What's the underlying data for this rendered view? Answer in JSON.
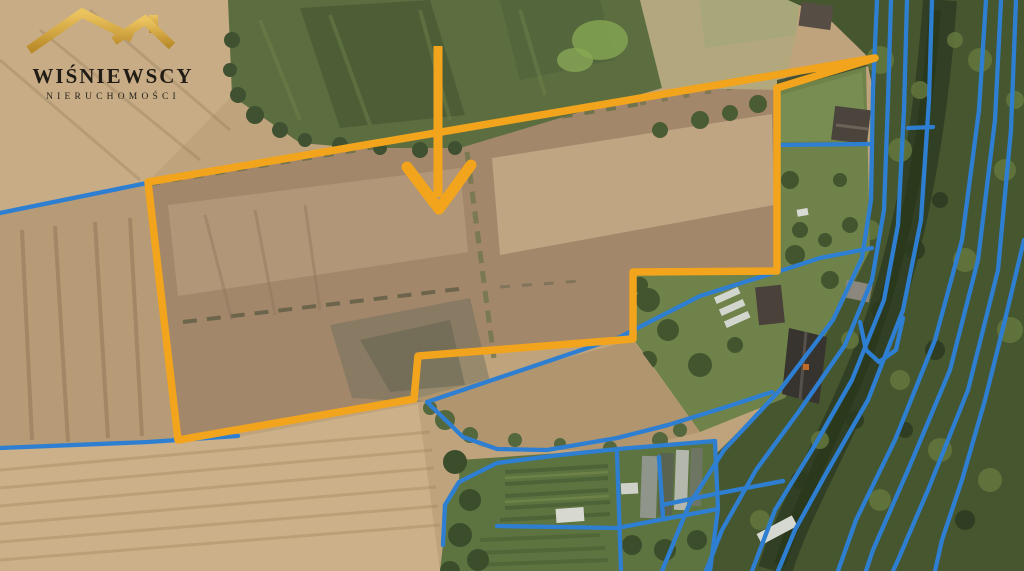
{
  "brand": {
    "name": "WIŚNIEWSCY",
    "subtitle": "NIERUCHOMOŚCI",
    "gold_color": "#D9A944",
    "text_color": "#211c16"
  },
  "map": {
    "canvas": {
      "width": 1024,
      "height": 571
    },
    "colors": {
      "plot_outline": "#F2A41C",
      "arrow": "#F2A41C",
      "cadastral": "#2E7FD2"
    },
    "plot_outline": {
      "stroke_width": 7.5,
      "points": "148,182 875,58 777,88 777,271 633,272 633,339 418,356 414,399 178,440"
    },
    "arrow": {
      "shaft_points": "438,46 438,197",
      "head_points": "407,167 439,209 471,165",
      "shaft_width": 9,
      "head_width": 11
    },
    "cadastral_lines": {
      "stroke_width": 4.3,
      "lines": [
        {
          "name": "boundary-nw",
          "points": "0,213 147,183"
        },
        {
          "name": "boundary-sw",
          "points": "0,448 148,442 238,436"
        },
        {
          "name": "homestead-boundary",
          "points": "872,248 820,258 783,270 700,296 620,337 427,402 463,437 497,449 547,450 617,438 668,425 726,407 772,392"
        },
        {
          "name": "garden-top",
          "points": "443,545 445,505 459,482 497,463 560,455 618,449 715,441"
        },
        {
          "name": "garden-bottom",
          "points": "497,526 560,527 617,528 718,509"
        },
        {
          "name": "garden-divider-1",
          "points": "617,452 621,571"
        },
        {
          "name": "garden-divider-2",
          "points": "659,457 663,517"
        },
        {
          "name": "garden-right-edge",
          "points": "715,441 718,509 710,571"
        },
        {
          "name": "connector-1",
          "points": "777,145 872,144"
        },
        {
          "name": "connector-2",
          "points": "908,128 933,127"
        },
        {
          "name": "connector-3",
          "points": "662,505 720,493 783,481"
        },
        {
          "name": "u-connector",
          "points": "903,318 896,350 879,362 866,350 860,322"
        },
        {
          "name": "river-line-1",
          "points": "877,0 873,90 871,200 862,258 833,320 780,390 724,450 689,505 662,571"
        },
        {
          "name": "river-line-2",
          "points": "891,0 888,100 884,210 872,280 845,345 800,410 756,470 722,530 706,571"
        },
        {
          "name": "river-line-3",
          "points": "907,0 904,110 898,225 884,300 852,380 812,450 775,510 752,571"
        },
        {
          "name": "river-line-4",
          "points": "932,0 929,100 921,220 903,310 868,400 828,470 795,530 778,571"
        },
        {
          "name": "river-line-5",
          "points": "986,0 979,110 962,240 935,340 895,440 856,520 838,571"
        },
        {
          "name": "river-line-6",
          "points": "1001,0 995,120 978,260 950,370 908,470 873,550 866,571"
        },
        {
          "name": "river-line-7",
          "points": "1016,0 1011,130 998,270 968,390 928,490 898,560 893,571"
        },
        {
          "name": "river-line-8",
          "points": "1024,240 1005,320 985,400 962,480 942,540 935,571"
        }
      ]
    }
  }
}
